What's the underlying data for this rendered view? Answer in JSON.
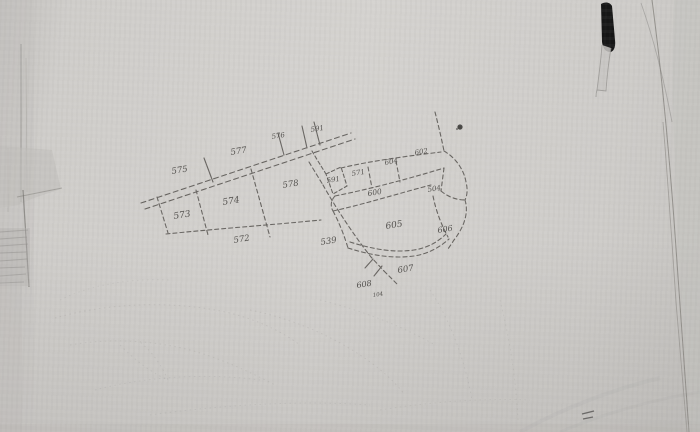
{
  "map": {
    "colors": {
      "paper": "#d0cecb",
      "ink": "#55524e",
      "label_ink": "#3e3c39",
      "pen_mark": "#161616"
    },
    "labels": [
      {
        "text": "575",
        "x": 172,
        "y": 174,
        "s": 8.5
      },
      {
        "text": "577",
        "x": 231,
        "y": 155,
        "s": 8.5
      },
      {
        "text": "576",
        "x": 272,
        "y": 139,
        "s": 7
      },
      {
        "text": "591",
        "x": 311,
        "y": 132,
        "s": 7
      },
      {
        "text": "578",
        "x": 283,
        "y": 188,
        "s": 8.5
      },
      {
        "text": "574",
        "x": 223,
        "y": 205,
        "s": 9
      },
      {
        "text": "573",
        "x": 174,
        "y": 219,
        "s": 9
      },
      {
        "text": "572",
        "x": 234,
        "y": 243,
        "s": 8.5
      },
      {
        "text": "539",
        "x": 321,
        "y": 245,
        "s": 8.5
      },
      {
        "text": "591",
        "x": 327,
        "y": 183,
        "s": 7
      },
      {
        "text": "571",
        "x": 352,
        "y": 176,
        "s": 7
      },
      {
        "text": "604",
        "x": 385,
        "y": 165,
        "s": 7
      },
      {
        "text": "602",
        "x": 415,
        "y": 155,
        "s": 7
      },
      {
        "text": "600",
        "x": 368,
        "y": 196,
        "s": 7.5
      },
      {
        "text": "504",
        "x": 428,
        "y": 192,
        "s": 7
      },
      {
        "text": "605",
        "x": 386,
        "y": 229,
        "s": 9
      },
      {
        "text": "606",
        "x": 438,
        "y": 233,
        "s": 8
      },
      {
        "text": "607",
        "x": 398,
        "y": 273,
        "s": 8.5
      },
      {
        "text": "608",
        "x": 357,
        "y": 288,
        "s": 8
      },
      {
        "text": "104",
        "x": 373,
        "y": 297,
        "s": 5.5
      }
    ]
  }
}
